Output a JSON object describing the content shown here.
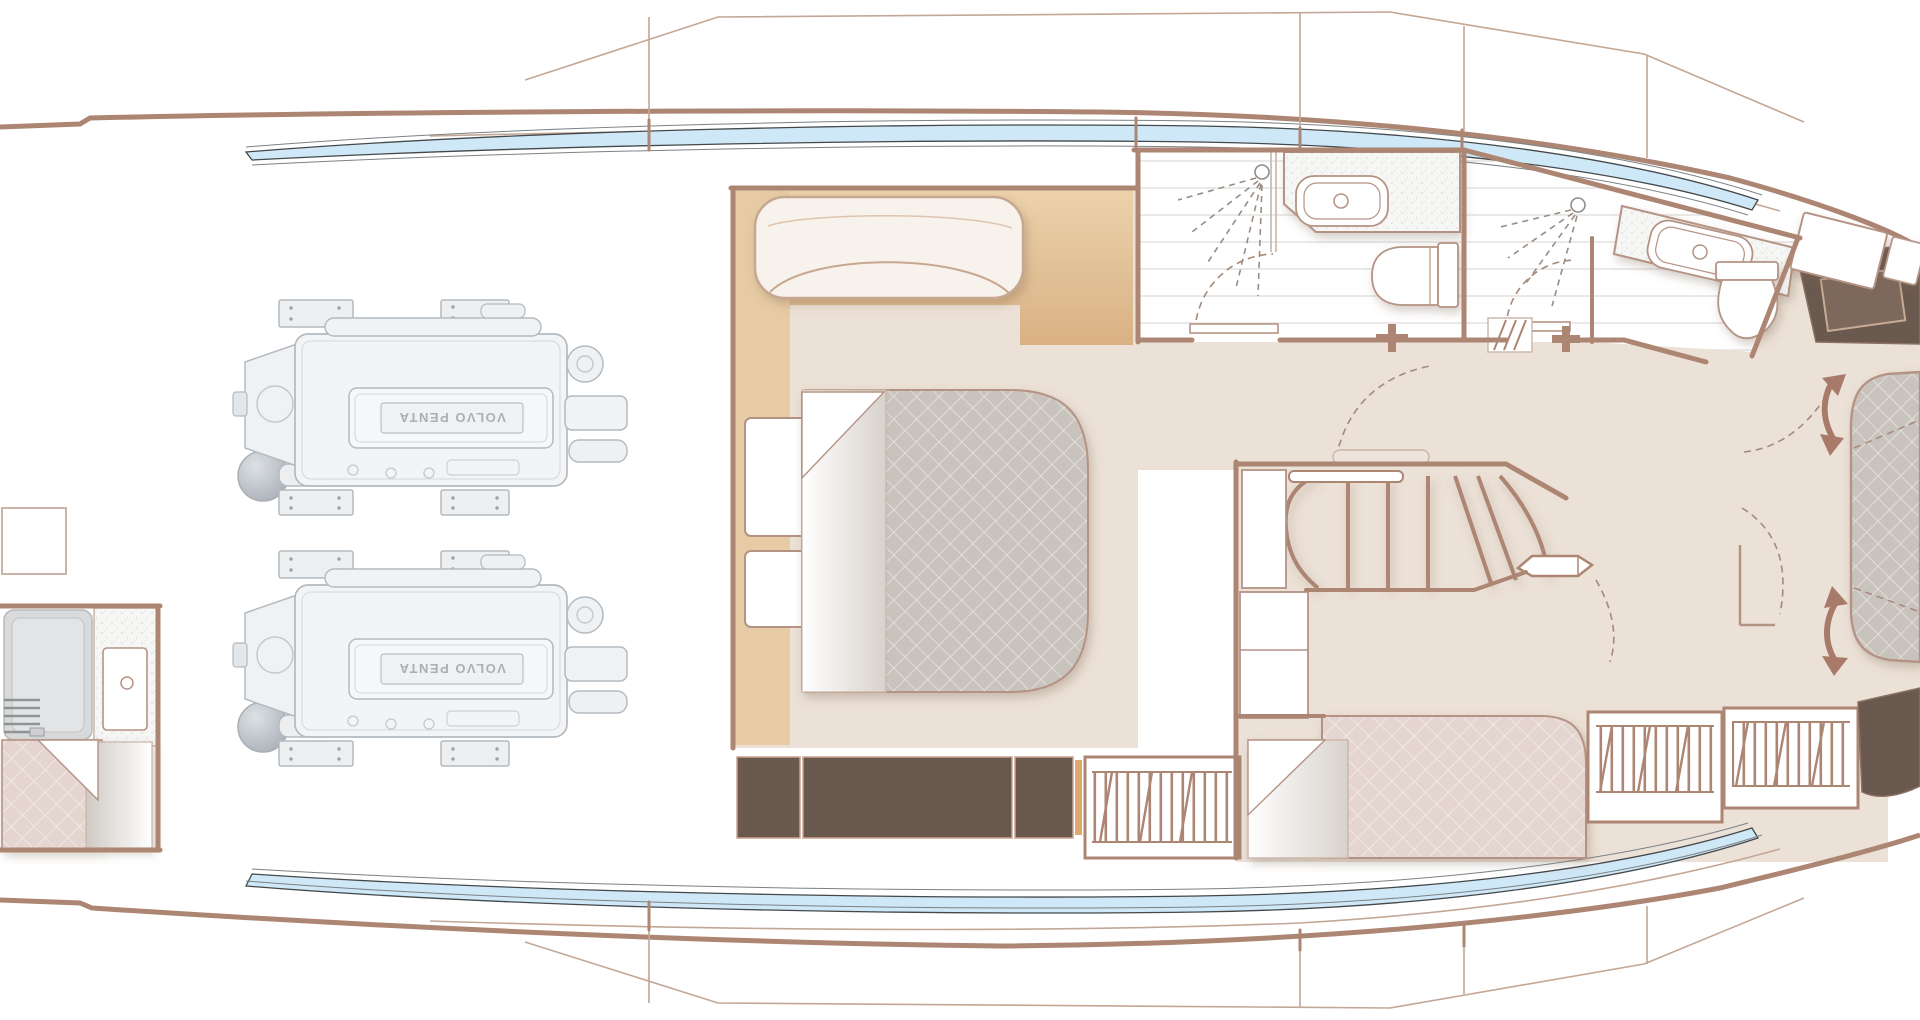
{
  "engine_room": {
    "engine_label": "VOLVO PENTA",
    "engine_count": 2
  },
  "palette": {
    "wall": "#ad8573",
    "wall_thin": "#c3a796",
    "floor": "#ece1d7",
    "headboard_tan": "#e2bf93",
    "dark_wood": "#6a594e",
    "quilt_grey": "#c9c3be",
    "quilt_pink": "#e4d5d0",
    "window_band_blue": "#cfe8f8",
    "engine_grey": "#b3bac0",
    "arrow_brown": "#a87a69",
    "dashed_line": "#a5897b"
  }
}
